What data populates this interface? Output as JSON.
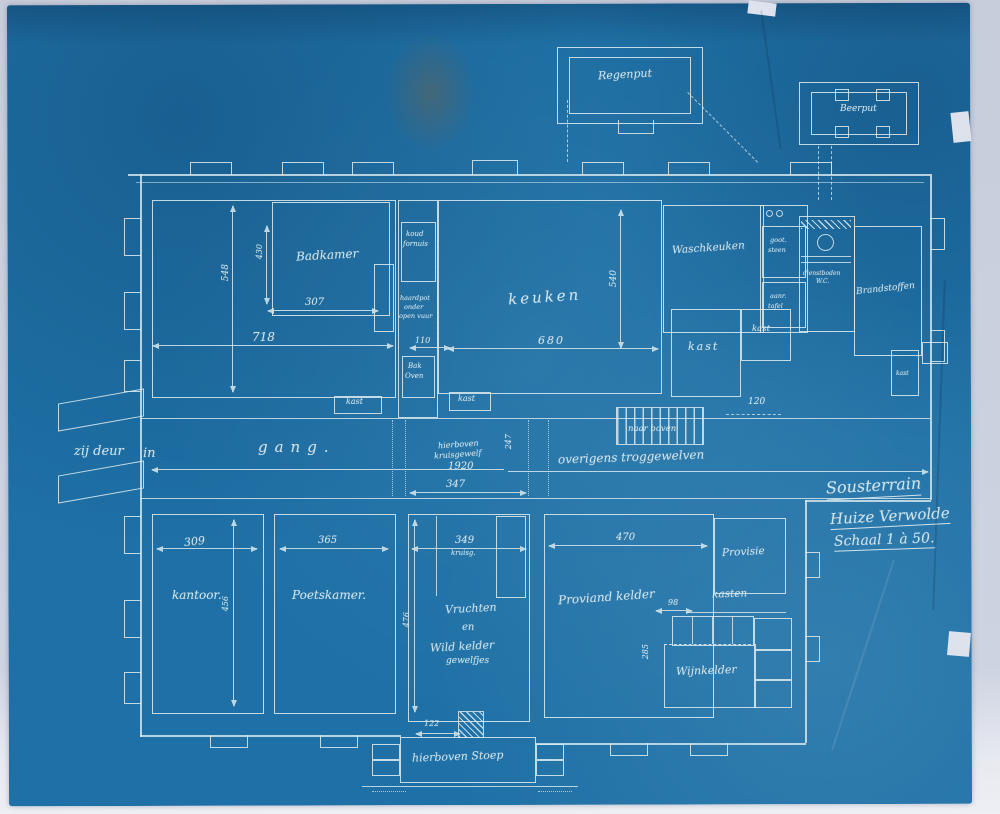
{
  "sheet": {
    "paper_color": "#1e70a6",
    "line_color": "#d9e9ed",
    "background_color": "#cdd3e1"
  },
  "title_block": {
    "line1": "Sousterrain",
    "line2": "Huize Verwolde",
    "line3": "Schaal 1 à 50."
  },
  "outbuildings": {
    "regenput": "Regenput",
    "beerput": "Beerput"
  },
  "rooms": {
    "badkamer": "Badkamer",
    "keuken": "keuken",
    "waschkeuken": "Waschkeuken",
    "brandstoffen": "Brandstoffen",
    "kantoor": "kantoor.",
    "poetskamer": "Poetskamer.",
    "vruchten_1": "Vruchten",
    "vruchten_2": "en",
    "vruchten_3": "Wild kelder",
    "vruchten_4": "gewelfjes",
    "proviand": "Proviand kelder",
    "provisie": "Provisie",
    "kasten": "kasten",
    "wijnkelder": "Wijnkelder",
    "gang": "gang.",
    "kast": "kast",
    "wc_1": "dienstboden",
    "wc_2": "W.C.",
    "koud_fornuis_1": "koud",
    "koud_fornuis_2": "fornuis",
    "haardpot_1": "haardpot",
    "haardpot_2": "onder",
    "haardpot_3": "open vuur",
    "bakoven_1": "Bak",
    "bakoven_2": "Oven",
    "gootsteen_1": "goot.",
    "gootsteen_2": "steen",
    "aanregttafel_1": "aanr.",
    "aanregttafel_2": "tafel"
  },
  "annotations": {
    "zij_deur": "zij deur",
    "in": "in",
    "naar_boven": "naar boven",
    "overigens": "overigens troggewelven",
    "hierboven_1": "hierboven",
    "hierboven_2": "kruisgewelf",
    "hierboven_3": "1920",
    "kruisg": "kruisg.",
    "hierboven_stoep": "hierboven Stoep"
  },
  "dimensions": {
    "d718": "718",
    "d548": "548",
    "d430": "430",
    "d307": "307",
    "d110": "110",
    "d680": "680",
    "d540": "540",
    "d120": "120",
    "d247": "247",
    "d347": "347",
    "d309": "309",
    "d365": "365",
    "d456": "456",
    "d349": "349",
    "d476": "476",
    "d122": "122",
    "d470": "470",
    "d98": "98",
    "d285": "285"
  }
}
